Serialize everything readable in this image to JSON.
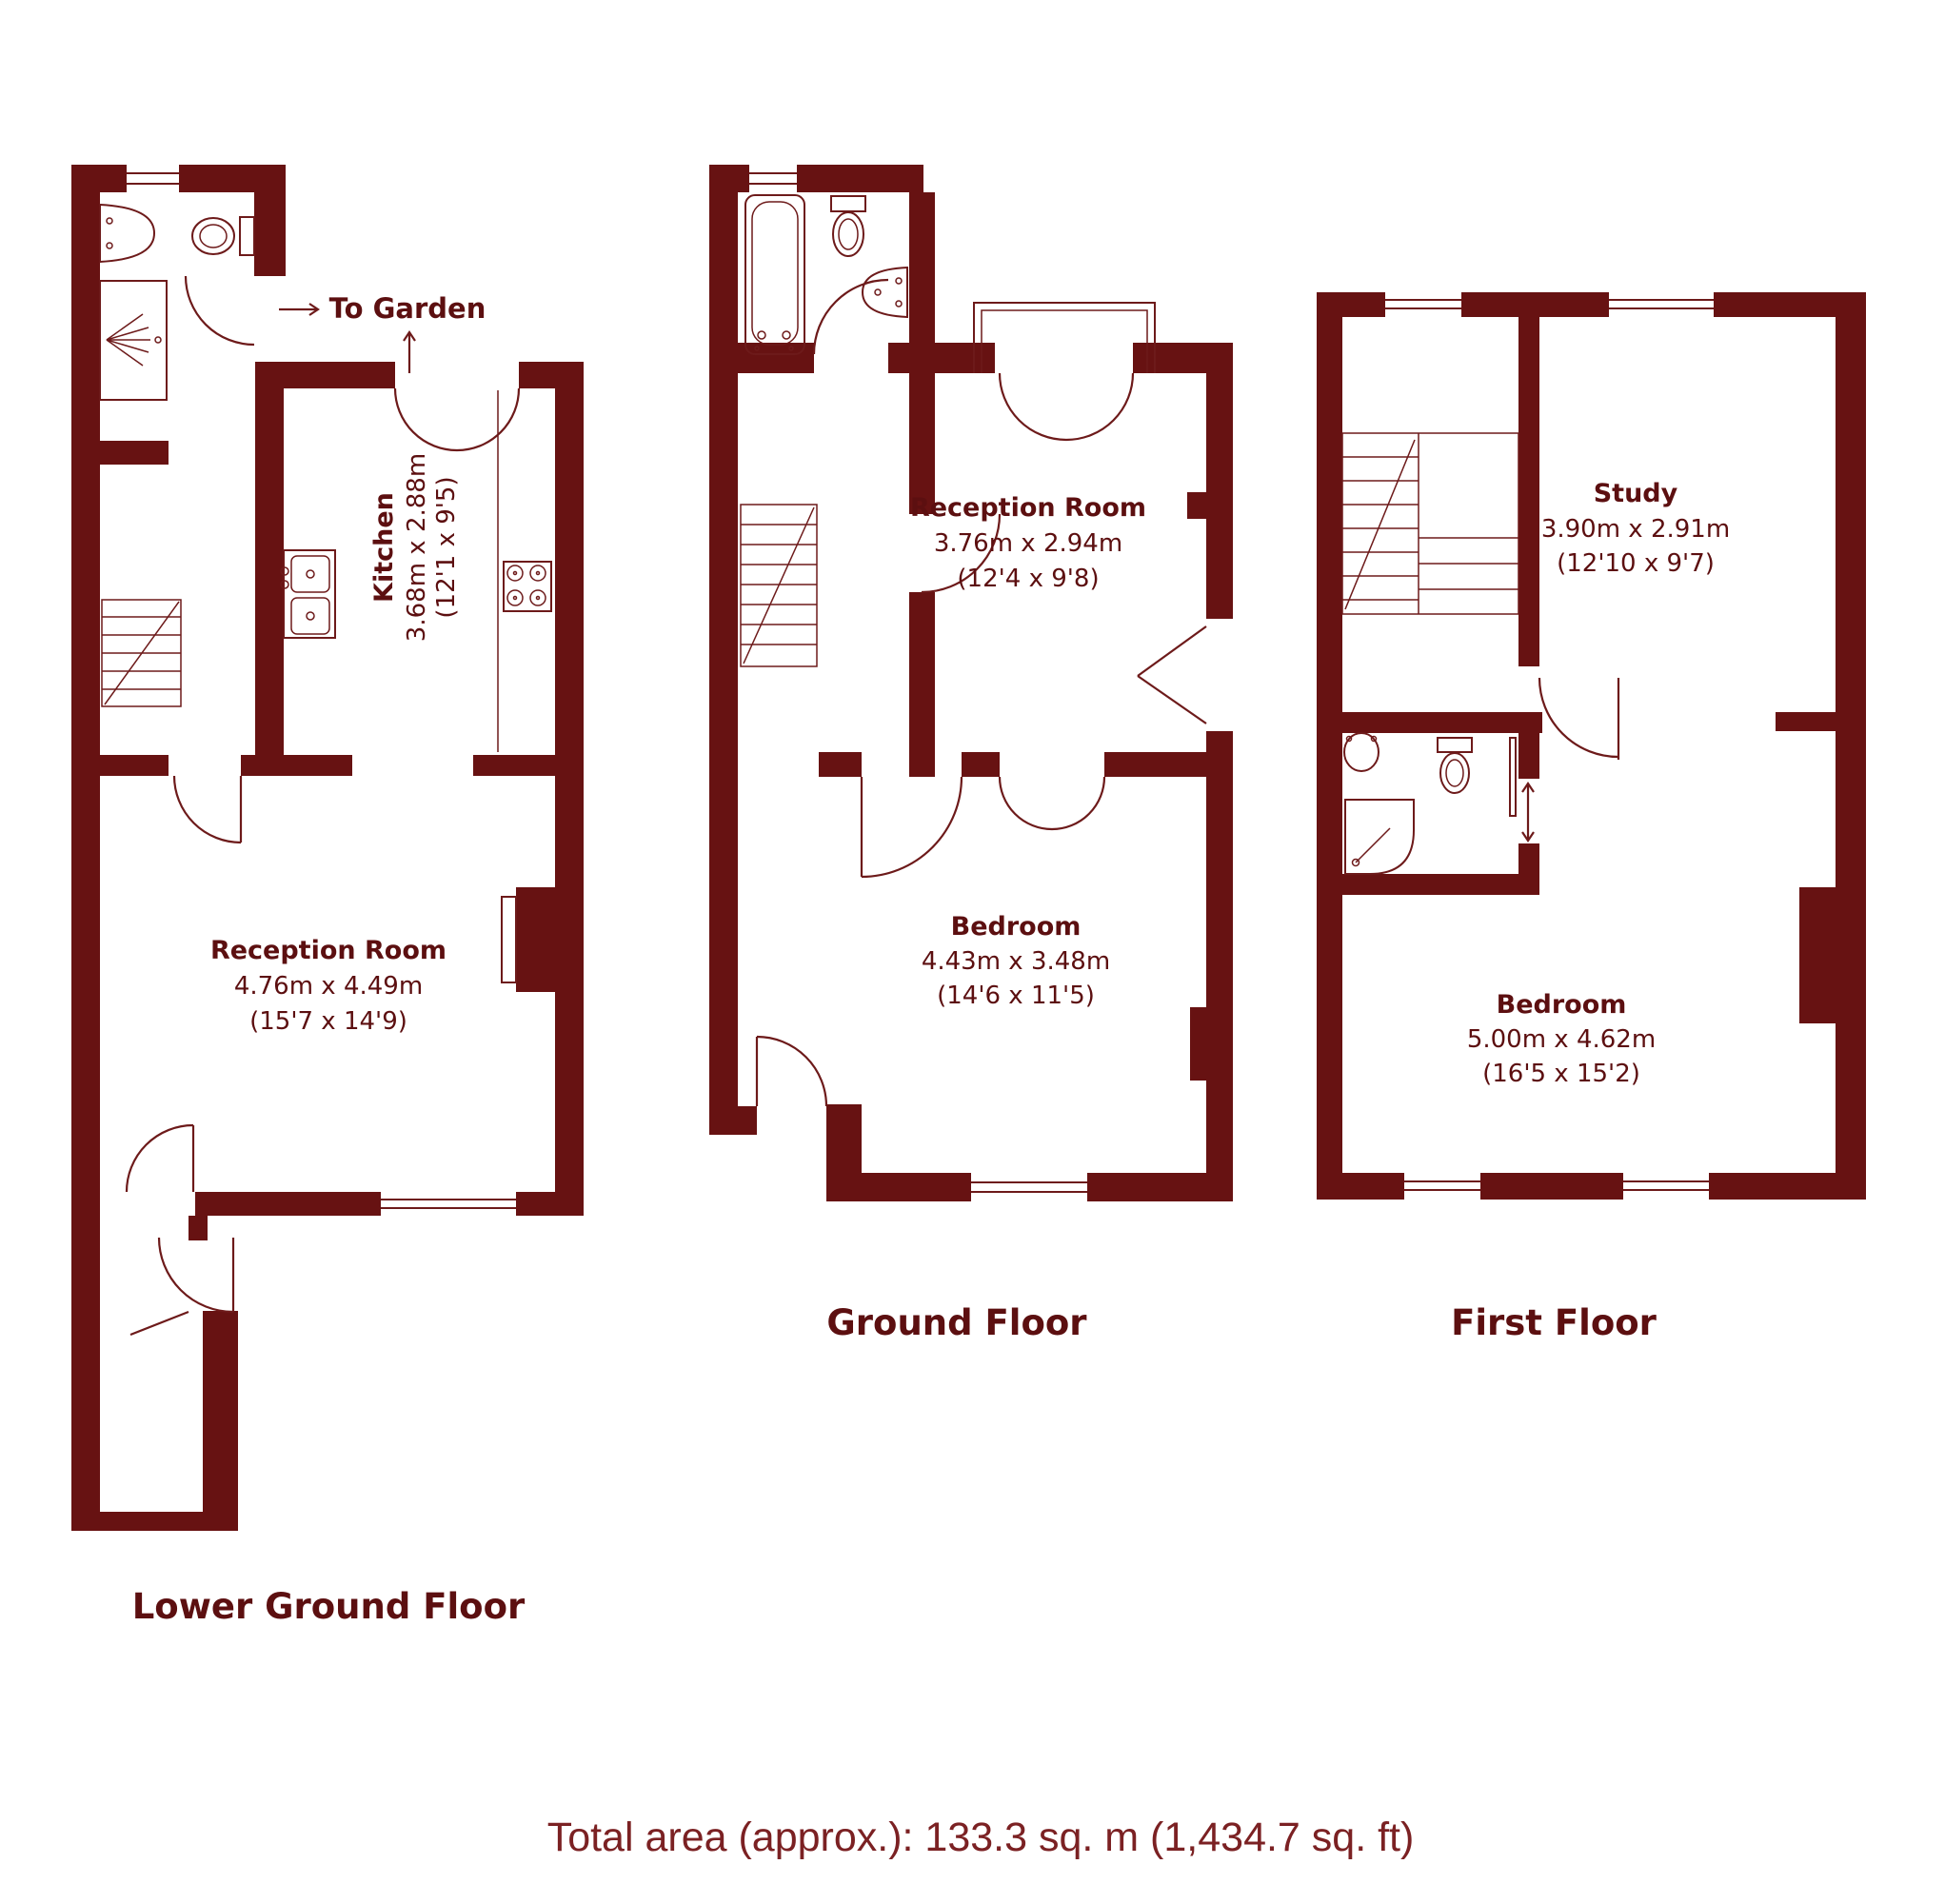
{
  "colors": {
    "wall": "#671212",
    "fixture_line": "#6d1a1a",
    "label_text": "#5c0f10",
    "footer_text": "#7b2123",
    "background": "#ffffff"
  },
  "floors": [
    {
      "id": "lower-ground-floor",
      "label": "Lower Ground Floor",
      "annotation": {
        "to_garden": "To Garden"
      },
      "rooms": [
        {
          "name": "Kitchen",
          "metric": "3.68m x 2.88m",
          "imperial": "(12'1 x 9'5)"
        },
        {
          "name": "Reception Room",
          "metric": "4.76m x 4.49m",
          "imperial": "(15'7 x 14'9)"
        }
      ],
      "fixtures": [
        "wash-basin",
        "toilet",
        "shower",
        "staircase",
        "kitchen-sink",
        "hob",
        "worktop",
        "fireplace",
        "chimney-breast"
      ]
    },
    {
      "id": "ground-floor",
      "label": "Ground Floor",
      "rooms": [
        {
          "name": "Reception Room",
          "metric": "3.76m x 2.94m",
          "imperial": "(12'4 x 9'8)"
        },
        {
          "name": "Bedroom",
          "metric": "4.43m x 3.48m",
          "imperial": "(14'6 x 11'5)"
        }
      ],
      "fixtures": [
        "bathtub",
        "toilet",
        "wash-basin",
        "staircase",
        "bay-window",
        "chimney-breast"
      ]
    },
    {
      "id": "first-floor",
      "label": "First Floor",
      "rooms": [
        {
          "name": "Study",
          "metric": "3.90m x 2.91m",
          "imperial": "(12'10 x 9'7)"
        },
        {
          "name": "Bedroom",
          "metric": "5.00m x 4.62m",
          "imperial": "(16'5 x 15'2)"
        }
      ],
      "fixtures": [
        "wash-basin",
        "toilet",
        "shower",
        "staircase",
        "sliding-door",
        "chimney-breast"
      ]
    }
  ],
  "footer": {
    "total_area": "Total area (approx.): 133.3 sq. m (1,434.7 sq. ft)"
  }
}
